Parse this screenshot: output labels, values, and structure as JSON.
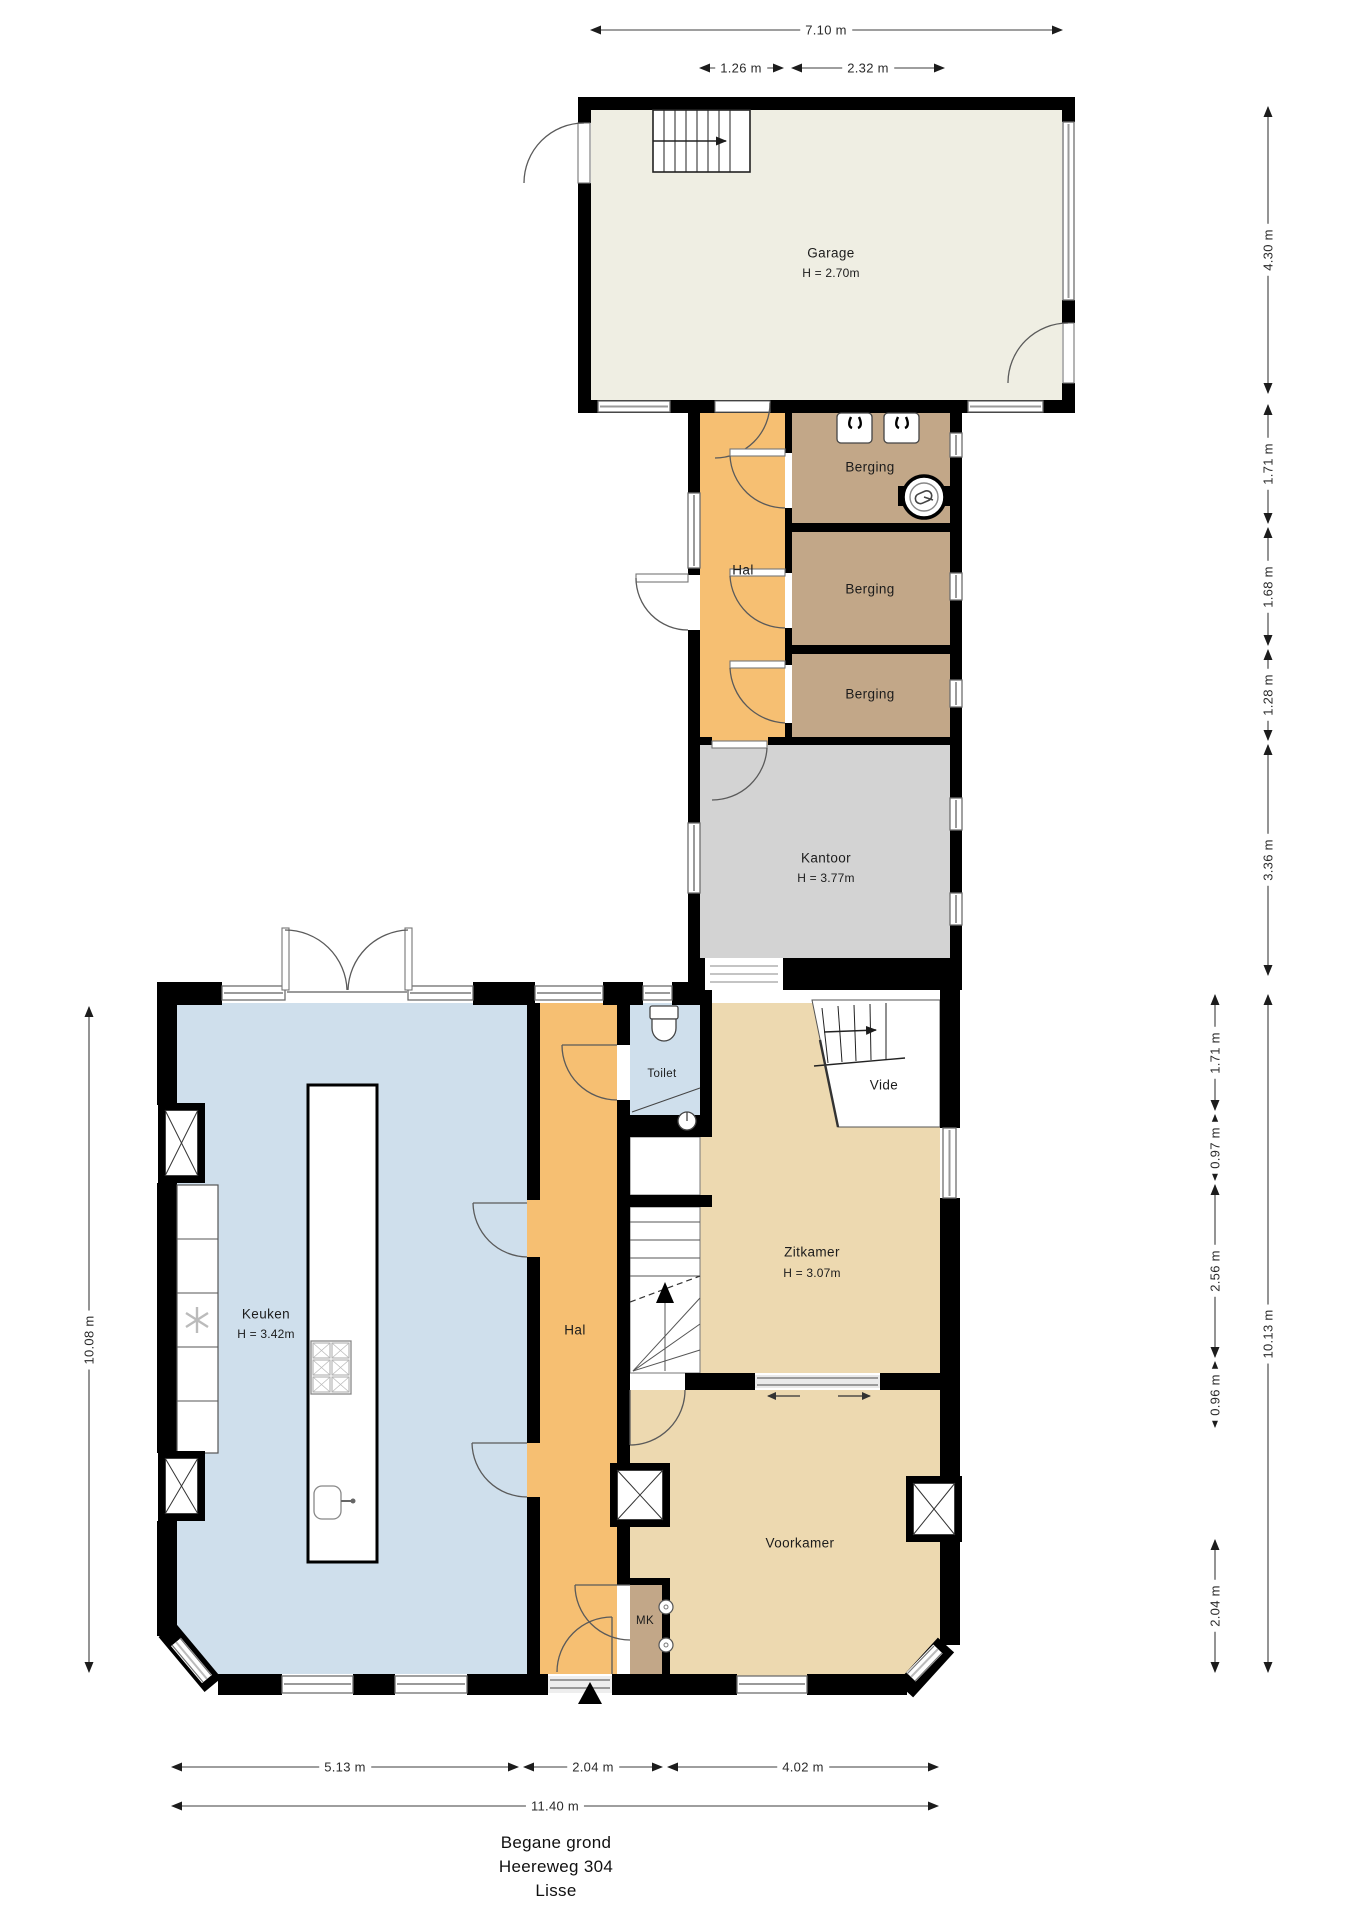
{
  "title": {
    "line1": "Begane grond",
    "line2": "Heereweg 304",
    "line3": "Lisse"
  },
  "rooms": {
    "garage": {
      "name": "Garage",
      "height": "H = 2.70m"
    },
    "hal_boven": {
      "name": "Hal"
    },
    "berging_1": {
      "name": "Berging"
    },
    "berging_2": {
      "name": "Berging"
    },
    "berging_3": {
      "name": "Berging"
    },
    "kantoor": {
      "name": "Kantoor",
      "height": "H = 3.77m"
    },
    "keuken": {
      "name": "Keuken",
      "height": "H = 3.42m"
    },
    "hal_beneden": {
      "name": "Hal"
    },
    "toilet": {
      "name": "Toilet"
    },
    "vide": {
      "name": "Vide"
    },
    "zitkamer": {
      "name": "Zitkamer",
      "height": "H = 3.07m"
    },
    "voorkamer": {
      "name": "Voorkamer"
    },
    "mk": {
      "name": "MK"
    }
  },
  "dimensions": {
    "top_total": "7.10 m",
    "top_hal": "1.26 m",
    "top_berging": "2.32 m",
    "right_garage": "4.30 m",
    "right_berging_1": "1.71 m",
    "right_berging_2": "1.68 m",
    "right_berging_3": "1.28 m",
    "right_kantoor": "3.36 m",
    "right_vide": "1.71 m",
    "right_window": "0.97 m",
    "right_zitkamer": "2.56 m",
    "right_tussen": "0.96 m",
    "right_voorkamer": "2.04 m",
    "right_total": "10.13 m",
    "left_total": "10.08 m",
    "bottom_keuken": "5.13 m",
    "bottom_hal": "2.04 m",
    "bottom_voorkamer": "4.02 m",
    "bottom_total": "11.40 m"
  },
  "colors": {
    "wall": "#000000",
    "garage": "#efeee3",
    "hal": "#f6bf72",
    "berging": "#c2a788",
    "kantoor": "#d3d3d3",
    "keuken": "#cfdfec",
    "toilet": "#cfdfec",
    "kamer": "#edd9b0"
  }
}
